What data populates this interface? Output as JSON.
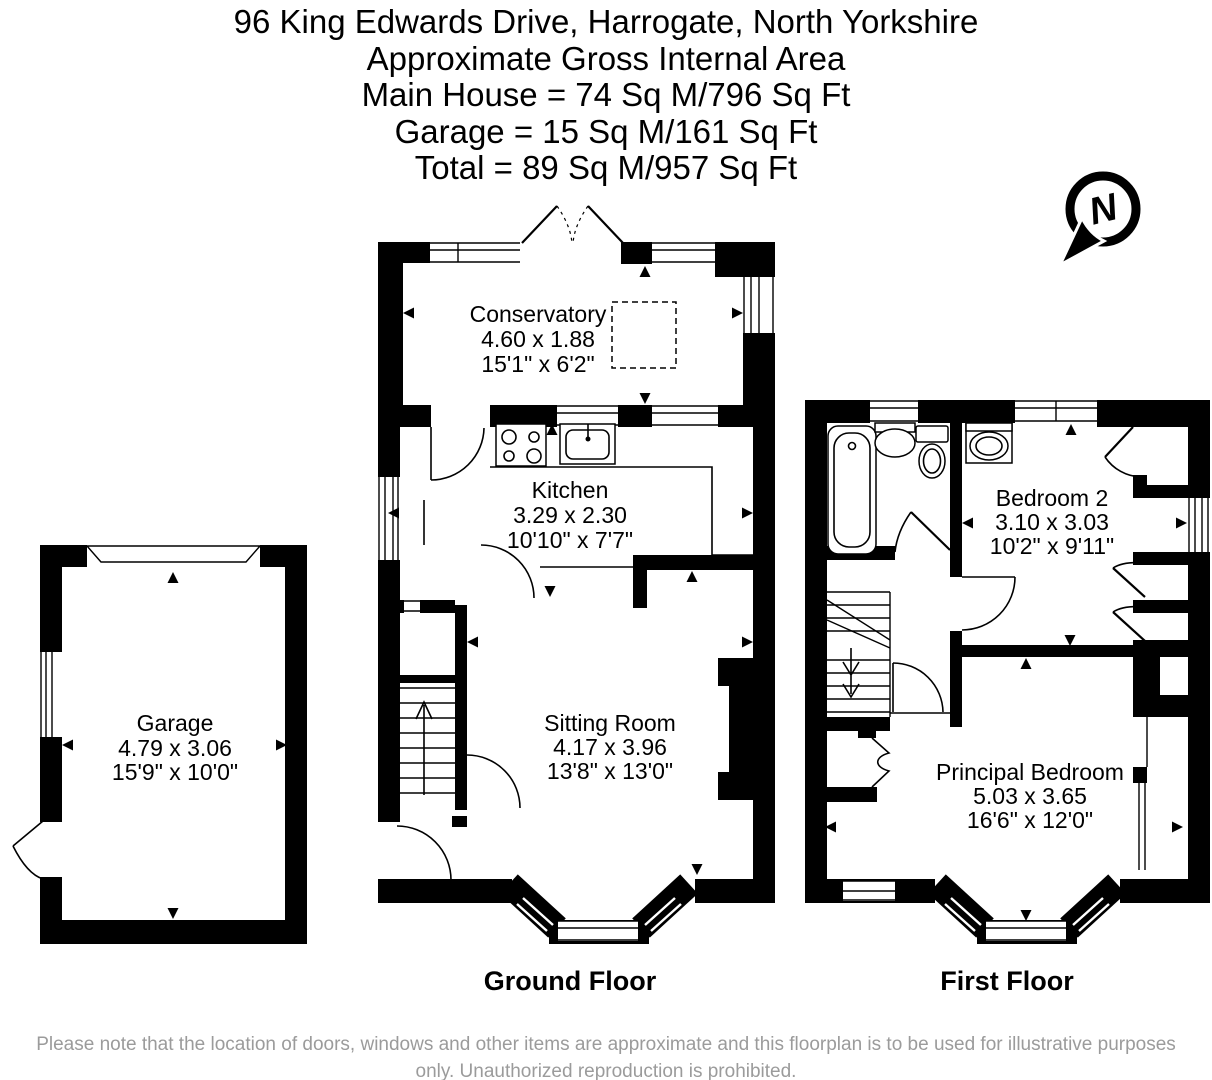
{
  "header": {
    "address": "96 King Edwards Drive, Harrogate, North Yorkshire",
    "area_heading": "Approximate Gross Internal Area",
    "main_house": "Main House = 74 Sq M/796 Sq Ft",
    "garage": "Garage = 15 Sq M/161 Sq Ft",
    "total": "Total = 89 Sq M/957 Sq Ft"
  },
  "compass": {
    "label": "N"
  },
  "rooms": {
    "conservatory": {
      "name": "Conservatory",
      "metric": "4.60 x 1.88",
      "imperial": "15'1\" x 6'2\""
    },
    "kitchen": {
      "name": "Kitchen",
      "metric": "3.29 x 2.30",
      "imperial": "10'10\" x 7'7\""
    },
    "sitting_room": {
      "name": "Sitting Room",
      "metric": "4.17 x 3.96",
      "imperial": "13'8\" x 13'0\""
    },
    "garage": {
      "name": "Garage",
      "metric": "4.79 x 3.06",
      "imperial": "15'9\" x 10'0\""
    },
    "bedroom_2": {
      "name": "Bedroom 2",
      "metric": "3.10 x 3.03",
      "imperial": "10'2\" x 9'11\""
    },
    "principal_bedroom": {
      "name": "Principal Bedroom",
      "metric": "5.03 x 3.65",
      "imperial": "16'6\" x 12'0\""
    }
  },
  "floors": {
    "ground": {
      "label": "Ground Floor"
    },
    "first": {
      "label": "First Floor"
    }
  },
  "disclaimer": "Please note that the location of doors, windows and other items are approximate and this floorplan is to be used for illustrative purposes only. Unauthorized reproduction is prohibited.",
  "icons": {
    "compass": "north-compass",
    "bath": "bathtub",
    "toilet": "toilet",
    "sink": "sink",
    "hob": "cooker-hob",
    "stairs": "staircase"
  },
  "colors": {
    "ink": "#000000",
    "disclaimer_gray": "#9b9b9b",
    "background": "#ffffff"
  }
}
